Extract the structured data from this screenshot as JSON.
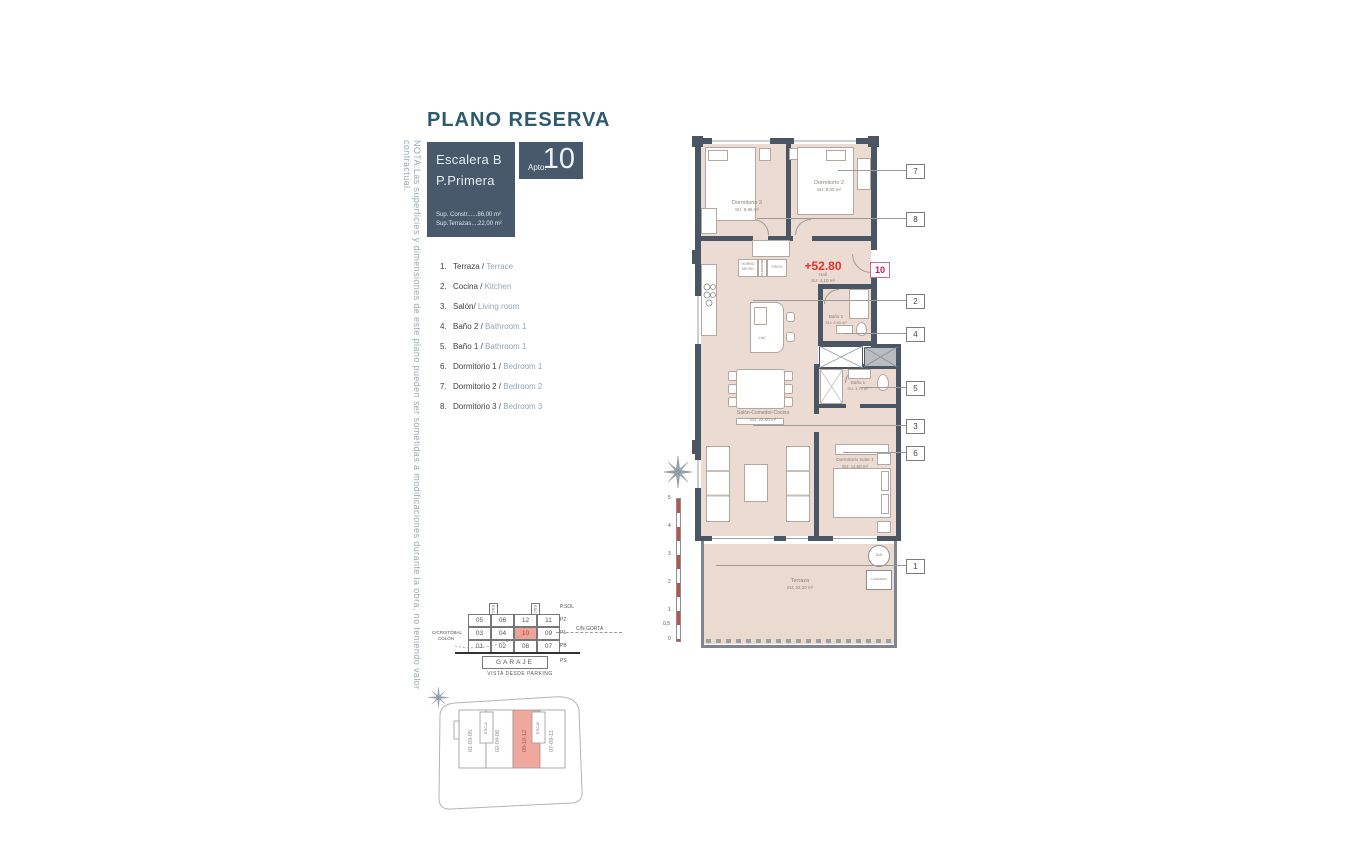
{
  "title": "PLANO RESERVA",
  "note": "NOTA:Las superficies y dimensiones de este plano pueden ser sometidas a modificaciones durante la obra, no teniendo valor contractual.",
  "header": {
    "escalera": "Escalera B",
    "planta": "P.Primera",
    "sup_constr": "Sup. Constr......86,00 m²",
    "sup_terrazas": "Sup.Terrazas....22,00 m²",
    "apto_label": "Apto.",
    "apto_number": "10"
  },
  "legend": [
    {
      "num": "1.",
      "es": "Terraza / ",
      "en": "Terrace"
    },
    {
      "num": "2.",
      "es": "Cocina / ",
      "en": "Kitchen"
    },
    {
      "num": "3.",
      "es": "Salón/ ",
      "en": "Living room"
    },
    {
      "num": "4.",
      "es": "Baño 2 / ",
      "en": "Bathroom 1"
    },
    {
      "num": "5.",
      "es": "Baño 1 / ",
      "en": "Bathroom 1"
    },
    {
      "num": "6.",
      "es": "Dormitorio 1 / ",
      "en": "Bedroom 1"
    },
    {
      "num": "7.",
      "es": "Dormitorio 2 / ",
      "en": "Bedroom 2"
    },
    {
      "num": "8.",
      "es": "Dormitorio 3 / ",
      "en": "Bedroom 3"
    }
  ],
  "plan": {
    "level": "+52.80",
    "badge": "10",
    "rooms": {
      "dorm3": {
        "name": "Dormitorio 3",
        "area": "SU: 9,96 m²"
      },
      "dorm2": {
        "name": "Dormitorio 2",
        "area": "SU: 8,00 m²"
      },
      "hall": {
        "name": "Hall",
        "area": "SU: 4,10 m²"
      },
      "bano2": {
        "name": "Baño 2",
        "area": "SU: 2,60 m²"
      },
      "bano1": {
        "name": "Baño 1",
        "area": "SU: 3,75 m²"
      },
      "salon": {
        "name": "Salón-Comedor-Cocina",
        "area": "SU: 22,60 m²"
      },
      "suite": {
        "name": "Dormitorio suite 1",
        "area": "SU: 11,60 m²"
      },
      "terraza": {
        "name": "Terraza",
        "area": "SU: 22,20 m²"
      }
    },
    "fixtures": {
      "lav": "LAV",
      "aa": "A/A",
      "lavadero": "LAVADERO",
      "horno": "HORNO MICRO",
      "despensa": "DESPENSA",
      "frigo": "FRIGO"
    },
    "callouts": [
      "7",
      "8",
      "2",
      "4",
      "5",
      "3",
      "6",
      "1"
    ]
  },
  "scalebar": {
    "ticks": [
      "5",
      "4",
      "3",
      "2",
      "1",
      "0,5",
      "0"
    ]
  },
  "garage": {
    "rows": [
      [
        "05",
        "06",
        "12",
        "11"
      ],
      [
        "03",
        "04",
        "10",
        "09"
      ],
      [
        "01",
        "02",
        "08",
        "07"
      ]
    ],
    "garaje": "GARAJE",
    "levels": [
      "P.SOL",
      "P2",
      "P1",
      "PB",
      "PS"
    ],
    "street_left_1": "C/CRISTÓBAL",
    "street_left_2": "COLÓN",
    "street_right": "C/N.GORTA",
    "caption": "VISTA DESDE PARKING",
    "esc_a": "ESC-A",
    "esc_b": "ESC-B"
  },
  "site": {
    "sections": [
      "01-03-05",
      "02-04-06",
      "08-10-12",
      "07-09-11"
    ],
    "esc_a": "ESC-A",
    "esc_b": "ESC-B"
  },
  "colors": {
    "slate": "#47596a",
    "teal": "#2d5a6e",
    "wall": "#4b5664",
    "floor": "#ebdbd2",
    "red": "#e5312a",
    "magenta": "#c2185b",
    "highlight": "#efa49a",
    "muted_blue": "#92a7b8"
  }
}
